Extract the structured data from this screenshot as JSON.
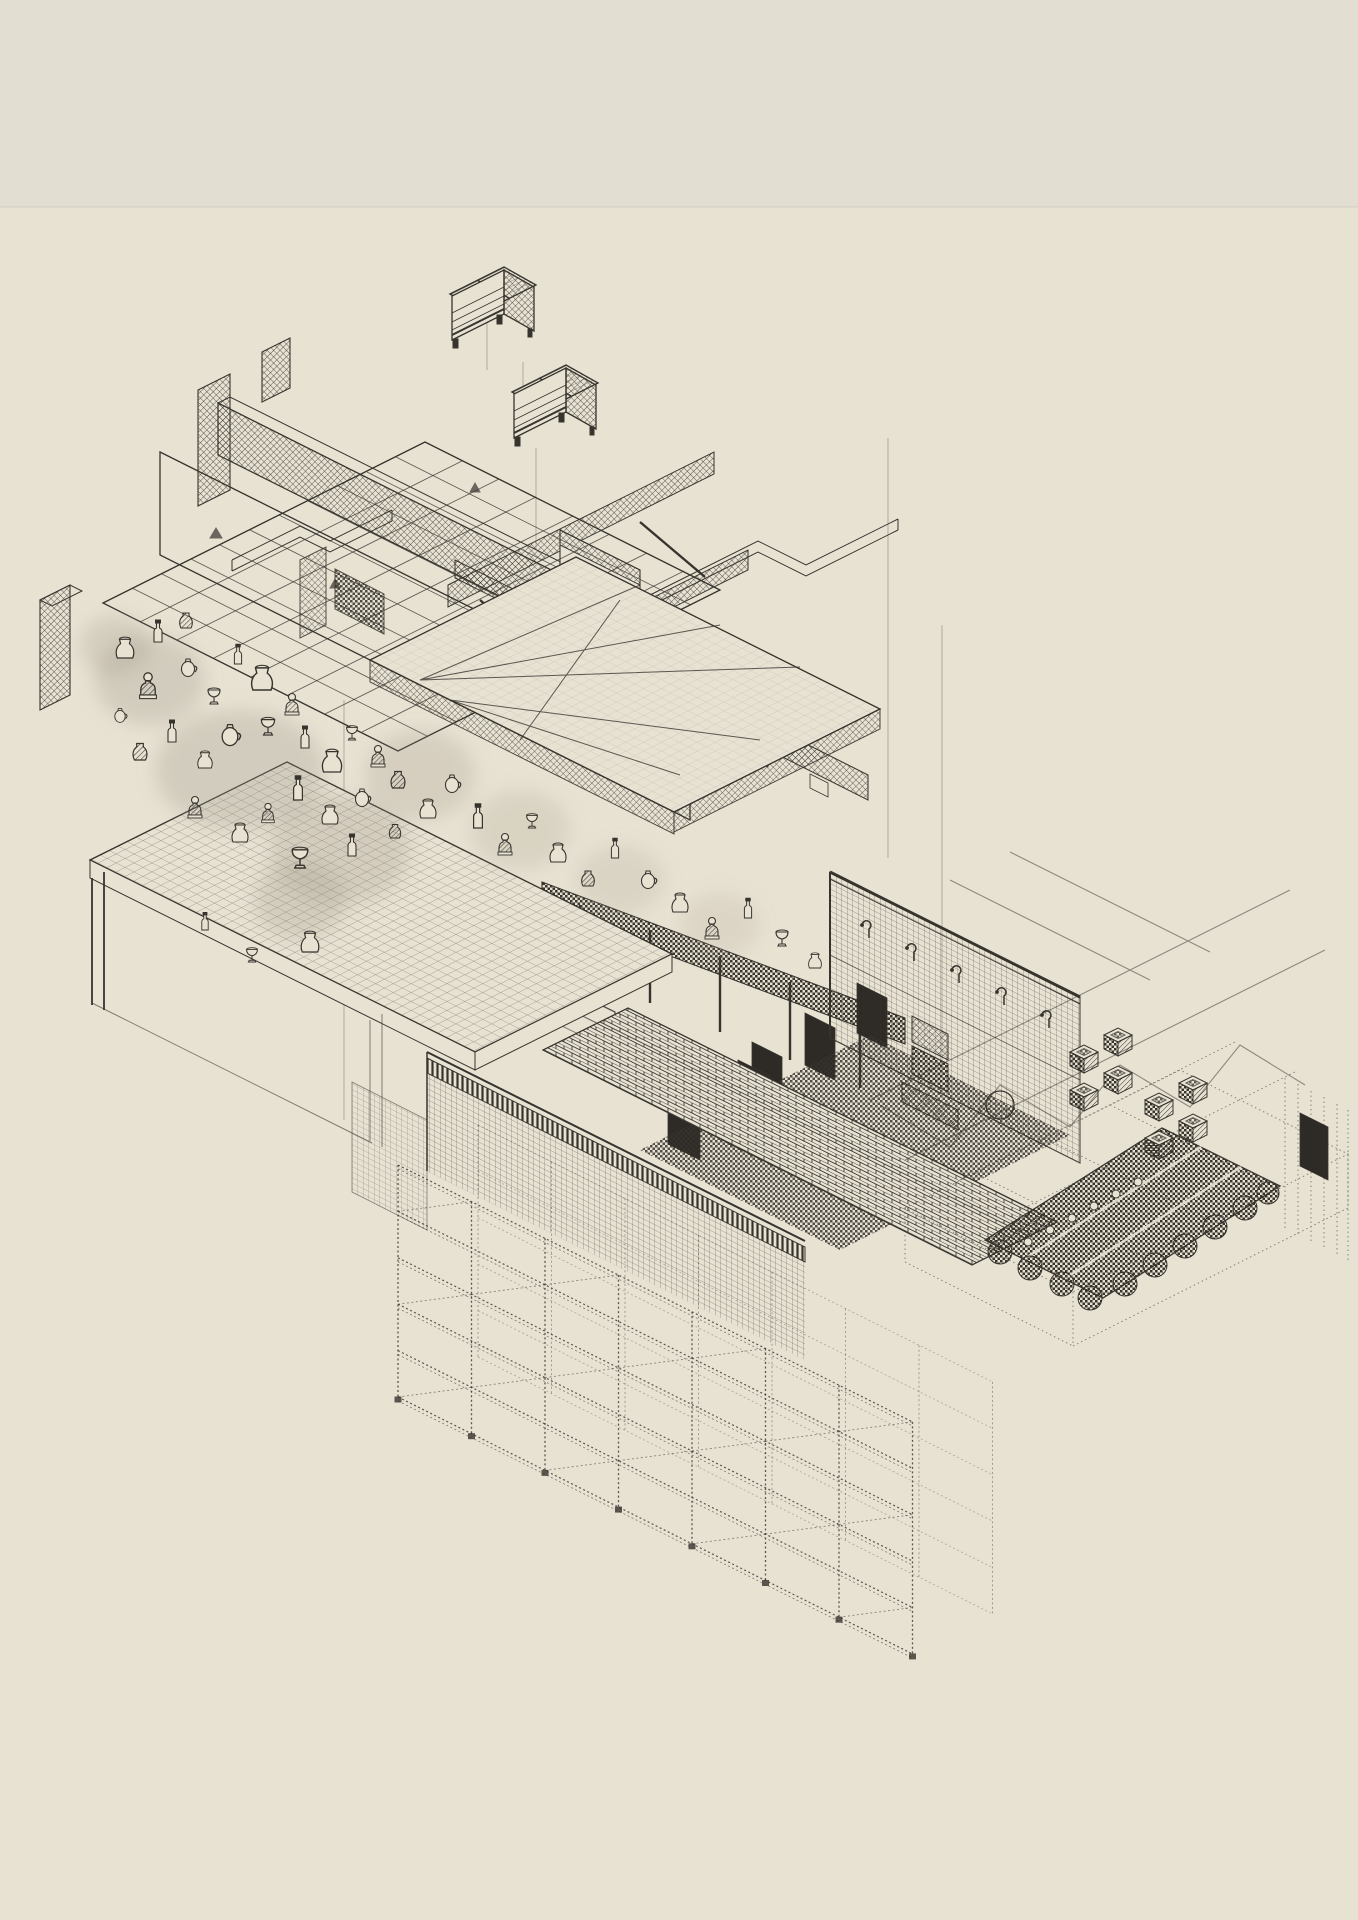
{
  "colors": {
    "ink": "#37342e",
    "ink_soft": "rgba(55,52,46,0.55)",
    "ink_faint": "rgba(55,52,46,0.35)",
    "paper": "#e8e2d3",
    "paper_top_strip": "#e3ded2",
    "halo_smudge": "#9a9484",
    "dark_panel": "#2e2b26"
  },
  "scene": {
    "components": [
      {
        "name": "dumpster-upper"
      },
      {
        "name": "dumpster-lower"
      },
      {
        "name": "building-assembly"
      },
      {
        "name": "ceiling-grid"
      },
      {
        "name": "duct-run"
      },
      {
        "name": "floor-plate"
      },
      {
        "name": "mezzanine-wedge"
      },
      {
        "name": "artifact-cloud"
      },
      {
        "name": "worktable"
      },
      {
        "name": "stepped-beam"
      },
      {
        "name": "pegboard-wall"
      },
      {
        "name": "checker-floor"
      },
      {
        "name": "press-column"
      },
      {
        "name": "woven-pots"
      },
      {
        "name": "brick-walkway"
      },
      {
        "name": "scalloped-roof"
      },
      {
        "name": "crate-stacks"
      },
      {
        "name": "storage-rack"
      },
      {
        "name": "mesh-fence"
      },
      {
        "name": "dotted-platform"
      },
      {
        "name": "roof-framing"
      },
      {
        "name": "guide-lines"
      }
    ]
  },
  "guides": [
    [
      487,
      292,
      370
    ],
    [
      523,
      362,
      430
    ],
    [
      536,
      448,
      560
    ],
    [
      888,
      438,
      858
    ],
    [
      942,
      625,
      1078
    ],
    [
      344,
      700,
      1120
    ]
  ],
  "artifacts": [
    [
      125,
      658,
      0,
      1.1
    ],
    [
      158,
      642,
      1,
      1
    ],
    [
      148,
      695,
      2,
      1.2
    ],
    [
      188,
      676,
      3,
      1
    ],
    [
      214,
      704,
      4,
      1
    ],
    [
      238,
      664,
      1,
      0.9
    ],
    [
      186,
      628,
      5,
      1
    ],
    [
      262,
      690,
      0,
      1.3
    ],
    [
      292,
      712,
      2,
      1
    ],
    [
      268,
      735,
      4,
      1.1
    ],
    [
      230,
      745,
      3,
      1.2
    ],
    [
      205,
      768,
      0,
      0.9
    ],
    [
      172,
      742,
      1,
      1
    ],
    [
      140,
      760,
      5,
      1.1
    ],
    [
      120,
      722,
      3,
      0.8
    ],
    [
      305,
      748,
      1,
      1
    ],
    [
      332,
      772,
      0,
      1.2
    ],
    [
      352,
      740,
      4,
      0.9
    ],
    [
      378,
      764,
      2,
      1
    ],
    [
      398,
      788,
      5,
      1.1
    ],
    [
      362,
      806,
      3,
      1
    ],
    [
      330,
      824,
      0,
      1
    ],
    [
      298,
      800,
      1,
      1.1
    ],
    [
      268,
      820,
      2,
      0.9
    ],
    [
      240,
      842,
      0,
      1
    ],
    [
      300,
      868,
      4,
      1.3
    ],
    [
      352,
      856,
      1,
      1
    ],
    [
      395,
      838,
      5,
      0.9
    ],
    [
      428,
      818,
      0,
      1
    ],
    [
      452,
      792,
      3,
      1
    ],
    [
      478,
      828,
      1,
      1.1
    ],
    [
      505,
      852,
      2,
      1
    ],
    [
      532,
      828,
      4,
      0.9
    ],
    [
      558,
      862,
      0,
      1
    ],
    [
      588,
      886,
      5,
      1
    ],
    [
      615,
      858,
      1,
      0.9
    ],
    [
      648,
      888,
      3,
      1
    ],
    [
      680,
      912,
      0,
      1
    ],
    [
      712,
      936,
      2,
      1
    ],
    [
      748,
      918,
      1,
      0.9
    ],
    [
      782,
      946,
      4,
      1
    ],
    [
      815,
      968,
      0,
      0.8
    ],
    [
      195,
      815,
      2,
      1
    ],
    [
      310,
      952,
      0,
      1.1
    ],
    [
      252,
      962,
      4,
      0.9
    ],
    [
      205,
      930,
      1,
      0.8
    ]
  ],
  "hooks": [
    [
      862,
      925
    ],
    [
      907,
      948
    ],
    [
      952,
      970
    ],
    [
      997,
      992
    ],
    [
      1042,
      1015
    ]
  ],
  "crates": [
    [
      1070,
      1060
    ],
    [
      1104,
      1043
    ],
    [
      1070,
      1098
    ],
    [
      1104,
      1081
    ],
    [
      1145,
      1108
    ],
    [
      1179,
      1091
    ],
    [
      1145,
      1146
    ],
    [
      1179,
      1129
    ]
  ],
  "rack": {
    "x": 398,
    "y": 1165,
    "bays": 7,
    "dx": 73.5,
    "dy": 36.7,
    "postH": 232,
    "levels": 5,
    "lh": 46.4,
    "rdx": 80,
    "rdy": -40
  }
}
